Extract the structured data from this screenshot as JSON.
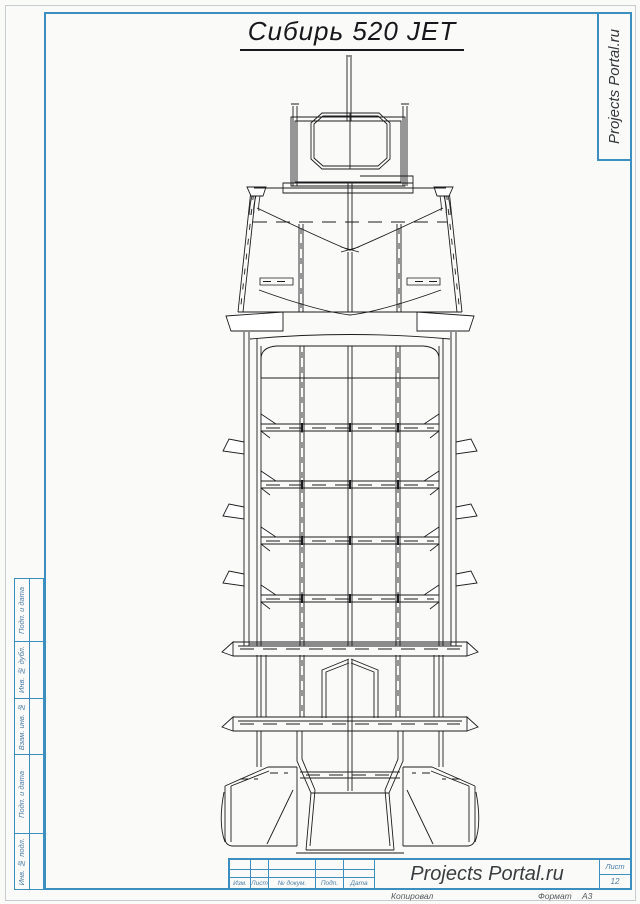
{
  "sheet": {
    "title": "Сибирь 520 JET",
    "watermark": "Projects Portal.ru"
  },
  "left_strip": {
    "cells": [
      {
        "label": "Подп. и дата"
      },
      {
        "label": "Инв. № дубл."
      },
      {
        "label": "Взам. инв. №"
      },
      {
        "label": "Подп. и дата"
      },
      {
        "label": "Инв. № подл."
      }
    ]
  },
  "title_block": {
    "revision_columns": [
      {
        "label": "Изм."
      },
      {
        "label": "Лист"
      },
      {
        "label": "№ докум."
      },
      {
        "label": "Подп."
      },
      {
        "label": "Дата"
      }
    ],
    "org_name": "Projects Portal.ru",
    "sheet_label": "Лист",
    "sheet_number": "12"
  },
  "footer": {
    "copied_label": "Копировал",
    "format_label": "Формат",
    "format_value": "А3"
  },
  "colors": {
    "frame_blue": "#3a8fc0",
    "drawing_line": "#1c1c1e",
    "label_blue": "#4d7ea8"
  }
}
